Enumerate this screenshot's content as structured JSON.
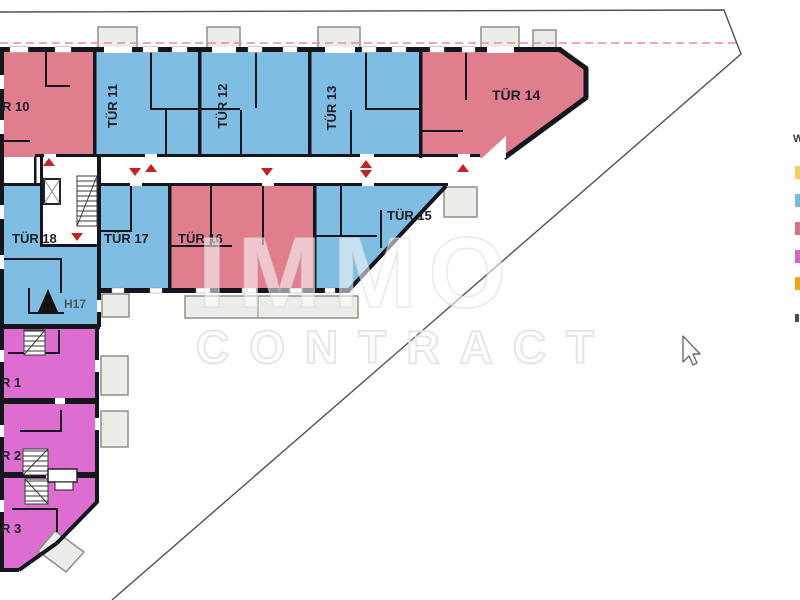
{
  "document": {
    "kind": "apartment floor plan (Grundriss)",
    "watermark": {
      "line1": "IMMO",
      "line2": "CONTRACT"
    }
  },
  "units": {
    "tuer10": {
      "label": "R 10",
      "color_key": "red"
    },
    "tuer11": {
      "label": "TÜR 11",
      "color_key": "blue"
    },
    "tuer12": {
      "label": "TÜR 12",
      "color_key": "blue"
    },
    "tuer13": {
      "label": "TÜR 13",
      "color_key": "blue"
    },
    "tuer14": {
      "label": "TÜR 14",
      "color_key": "red"
    },
    "tuer15": {
      "label": "TÜR 15",
      "color_key": "blue"
    },
    "tuer16": {
      "label": "TÜR 16",
      "color_key": "red"
    },
    "tuer17": {
      "label": "TÜR 17",
      "color_key": "blue"
    },
    "tuer18": {
      "label": "TÜR 18",
      "color_key": "blue"
    },
    "r1": {
      "label": "R 1",
      "color_key": "magenta"
    },
    "r2": {
      "label": "R 2",
      "color_key": "magenta"
    },
    "r3": {
      "label": "R 3",
      "color_key": "magenta"
    }
  },
  "annotations": {
    "elevator_label": "H17"
  },
  "legend": {
    "visible_label": "W",
    "swatches": [
      {
        "name": "yellow",
        "color": "#F0D060"
      },
      {
        "name": "blue",
        "color": "#7AB8DC"
      },
      {
        "name": "red",
        "color": "#DC7186"
      },
      {
        "name": "magenta",
        "color": "#D468C4"
      },
      {
        "name": "orange",
        "color": "#F0A41C"
      }
    ]
  },
  "colors": {
    "unit_blue": "#7FBDE2",
    "unit_red": "#E17E8E",
    "unit_magenta": "#DE6DD1",
    "balcony_fill": "#ECECE8",
    "wall": "#15151d",
    "corridor": "#FFFFFF",
    "boundary_line": "#4C5357",
    "setback_dashed_line": "#E889A0",
    "door_arrow": "#C62222",
    "label_text": "#1F1F2B"
  }
}
